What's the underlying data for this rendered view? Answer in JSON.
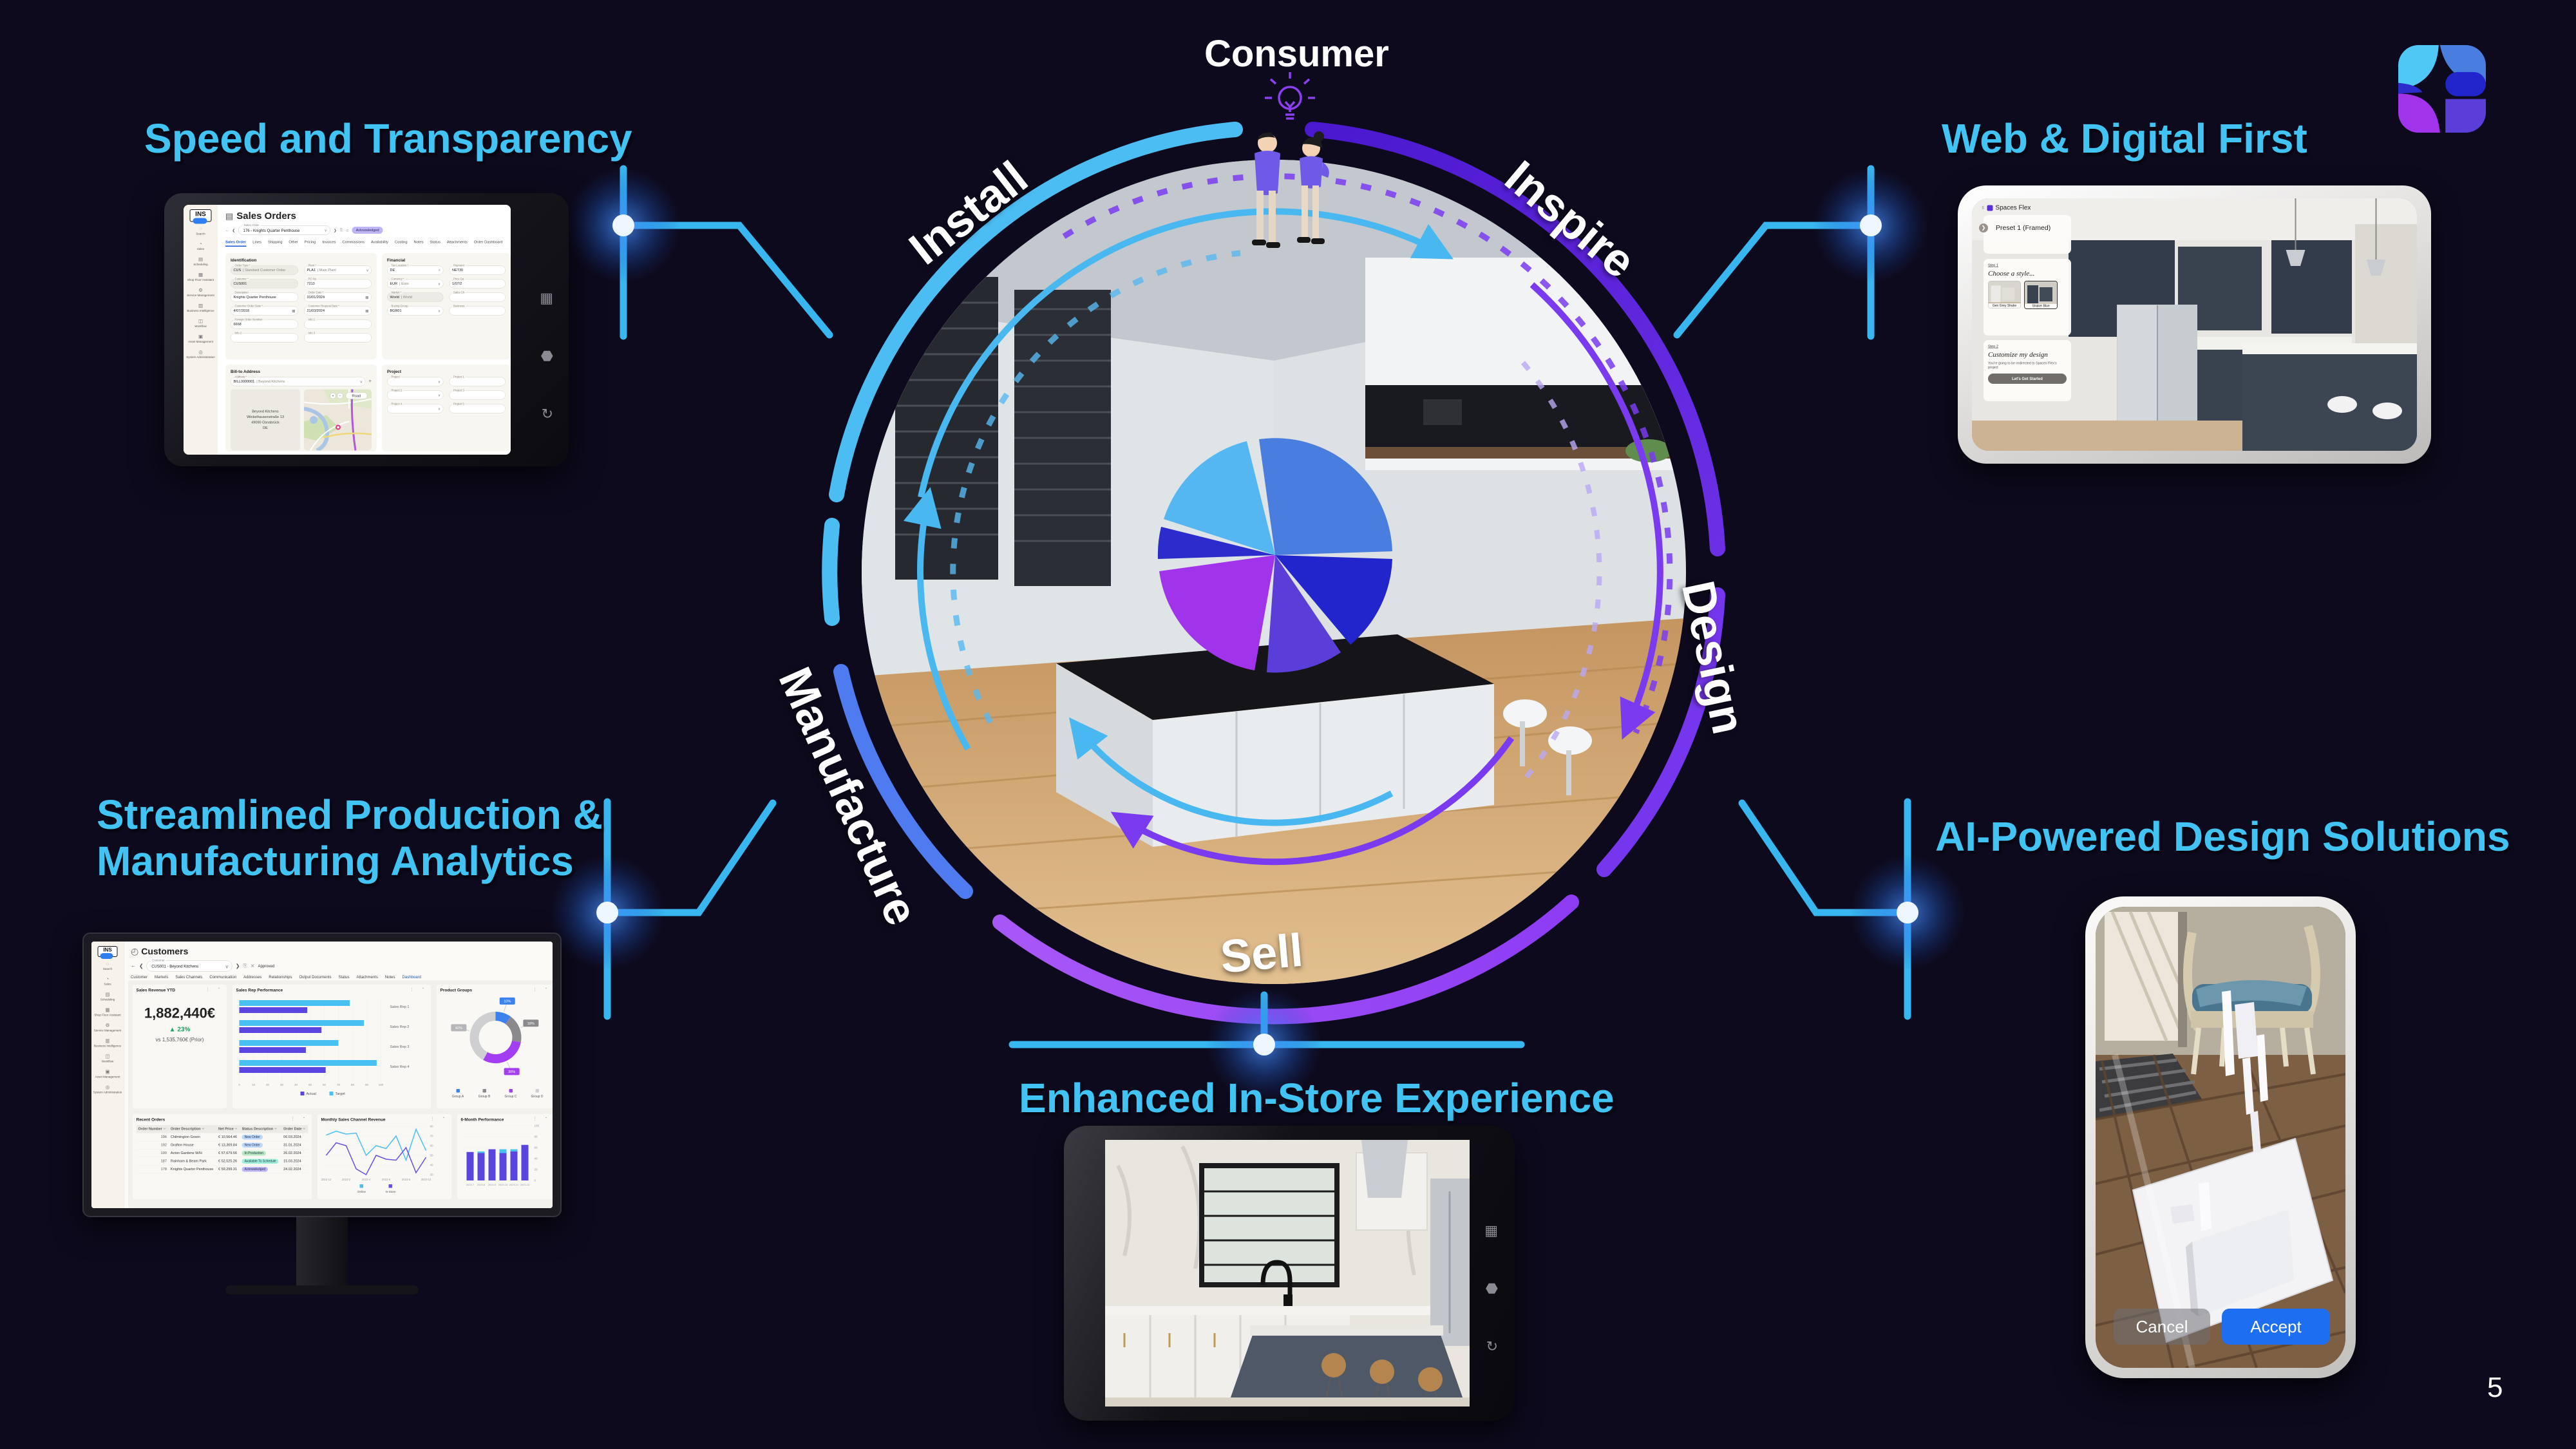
{
  "page": {
    "number": "5",
    "accent": "#41c3f3",
    "background": "#0d0a1d"
  },
  "titles": {
    "speed": "Speed and Transparency",
    "web": "Web & Digital First",
    "production_l1": "Streamlined Production &",
    "production_l2": "Manufacturing Analytics",
    "ai": "AI-Powered Design Solutions",
    "instore": "Enhanced In-Store Experience"
  },
  "cycle": {
    "consumer": "Consumer",
    "stages": {
      "install": "Install",
      "inspire": "Inspire",
      "design": "Design",
      "sell": "Sell",
      "manufacture": "Manufacture"
    },
    "ring_colors": {
      "cyan": "#4bbdf2",
      "purple_dark": "#5122d2",
      "purple": "#7636ee",
      "magenta": "#9d4cf5",
      "blue": "#4e7cf0"
    }
  },
  "erp": {
    "logo": "INS",
    "title": "Sales Orders",
    "selector_label": "Sales Order",
    "selector_value": "176 - Knights Quarter Penthouse",
    "status_badge": "Acknowledged",
    "tabs": [
      "Sales Order",
      "Lines",
      "Shipping",
      "Other",
      "Pricing",
      "Invoices",
      "Commissions",
      "Availability",
      "Costing",
      "Notes",
      "Status",
      "Attachments",
      "Order Dashboard"
    ],
    "sidebar": [
      "Search",
      "Sales",
      "Scheduling",
      "Shop Floor Assistant",
      "Service Management",
      "Business Intelligence",
      "Workflow",
      "Asset Management",
      "System Administration"
    ],
    "sections": {
      "identification": "Identification",
      "financial": "Financial",
      "billto": "Bill-to Address",
      "project": "Project"
    },
    "id_left": [
      {
        "l": "Order Type *",
        "v": "CUS",
        "s": "| Standard Customer Order",
        "grey": true
      },
      {
        "l": "Customer *",
        "v": "CUS001",
        "grey": true
      },
      {
        "l": "Description",
        "v": "Knights Quarter Penthouse"
      },
      {
        "l": "Customer Order Date *",
        "v": "4/07/2018",
        "icon": "date"
      },
      {
        "l": "Foreign Order Number",
        "v": "6668"
      },
      {
        "l": "Info 2",
        "v": ""
      }
    ],
    "id_right": [
      {
        "l": "Plant *",
        "v": "PLA1",
        "s": "| Main Plant",
        "icon": "select"
      },
      {
        "l": "PO No",
        "v": "7213"
      },
      {
        "l": "Order Date *",
        "v": "31/01/2024",
        "icon": "date"
      },
      {
        "l": "Customer Request Date *",
        "v": "21/03/2024",
        "icon": "date"
      },
      {
        "l": "Info 1",
        "v": ""
      },
      {
        "l": "Info 3",
        "v": ""
      }
    ],
    "fin_left": [
      {
        "l": "Tax Location *",
        "v": "DE",
        "icon": "search"
      },
      {
        "l": "Currency *",
        "v": "EUR",
        "s": "| Euro",
        "icon": "select"
      },
      {
        "l": "Market *",
        "v": "World",
        "s": "| World",
        "grey": true
      },
      {
        "l": "Buying Group",
        "v": "BGR01",
        "icon": "select"
      }
    ],
    "fin_right": [
      {
        "l": "Payment",
        "v": "NET30"
      },
      {
        "l": "Price Da",
        "v": "1/07/2"
      },
      {
        "l": "Sales Ch",
        "v": ""
      },
      {
        "l": "Business",
        "v": ""
      }
    ],
    "address_code": "BILL0000001",
    "address_name": "| Beyond Kitchens",
    "address_lines": [
      "Beyond Kitchens",
      "Winkelhausenstraße 13",
      "49090 Osnabrück",
      "DE"
    ],
    "map_button": "Road",
    "project_left": [
      "Project",
      "Project 2",
      "Project 4"
    ],
    "project_right": [
      "Project 1",
      "Project 3",
      "Project 5"
    ]
  },
  "spaces": {
    "app": "Spaces Flex",
    "preset": "Preset 1 (Framed)",
    "step1_label": "Step 1",
    "step1_title": "Choose a style...",
    "styles": [
      "Gen Grey Shake",
      "Shaker Blue"
    ],
    "step2_label": "Step 2",
    "step2_title": "Customize my design",
    "step2_note": "You're going to be redirected to Spaces Flex's project",
    "cta": "Let's Get Started"
  },
  "dash": {
    "title": "Customers",
    "selector": "CUS001 - Beyond Kitchens",
    "status": "Approved",
    "tabs": [
      "Customer",
      "Markets",
      "Sales Channels",
      "Communication",
      "Addresses",
      "Relationships",
      "Output Documents",
      "Status",
      "Attachments",
      "Notes",
      "Dashboard"
    ],
    "active_tab": 10,
    "sidebar": [
      "Search",
      "Sales",
      "Scheduling",
      "Shop Floor Assistant",
      "Service Management",
      "Business Intelligence",
      "Workflow",
      "Asset Management",
      "System Administration"
    ],
    "cards": {
      "revenue": "Sales Revenue YTD",
      "reps": "Sales Rep Performance",
      "groups": "Product Groups",
      "orders": "Recent Orders",
      "monthly": "Monthly Sales Channel Revenue",
      "sixmonth": "6-Month Performance"
    },
    "revenue": {
      "value": "1,882,440€",
      "delta": "▲ 23%",
      "prior": "vs 1,535,760€ (Prior)"
    },
    "orders_columns": [
      "Order Number",
      "Order Description",
      "Net Price",
      "Status Description",
      "Order Date"
    ],
    "orders_rows": [
      [
        "196",
        "Chilmington Green",
        "€ 10,564.46",
        "New Order",
        "06.03.2024"
      ],
      [
        "192",
        "Grafton House",
        "€ 13,369.84",
        "New Order",
        "31.01.2024"
      ],
      [
        "190",
        "Acton Gardens W/H",
        "€ 57,679.56",
        "In Production",
        "26.02.2024"
      ],
      [
        "187",
        "Rainham & Beam Park",
        "€ 52,525.26",
        "Available To Schedule",
        "15.03.2024"
      ],
      [
        "178",
        "Knights Quarter Penthouse",
        "€ 59,299.31",
        "Acknowledged",
        "24.02.2024"
      ]
    ],
    "status_colors": {
      "New Order": "#bcd7fb",
      "In Production": "#b9e7bf",
      "Available To Schedule": "#9ff0d9",
      "Acknowledged": "#beb5f7"
    }
  },
  "ar": {
    "cancel": "Cancel",
    "accept": "Accept"
  },
  "chart_data": [
    {
      "type": "bar",
      "orientation": "horizontal",
      "title": "Sales Rep Performance",
      "categories": [
        "Sales Rep 1",
        "Sales Rep 2",
        "Sales Rep 3",
        "Sales Rep 4"
      ],
      "series": [
        {
          "name": "Target",
          "color": "#49c0f2",
          "values": [
            78,
            88,
            70,
            97
          ]
        },
        {
          "name": "Actual",
          "color": "#5b45e0",
          "values": [
            48,
            58,
            47,
            61
          ]
        }
      ],
      "xlim": [
        0,
        100
      ],
      "xticks": [
        0,
        10,
        20,
        30,
        40,
        50,
        60,
        70,
        80,
        90,
        100
      ],
      "legend": [
        "Actual",
        "Target"
      ],
      "legend_colors": [
        "#5b45e0",
        "#49c0f2"
      ]
    },
    {
      "type": "pie",
      "title": "Product Groups",
      "labels": [
        "Group A",
        "Group B",
        "Group C",
        "Group D"
      ],
      "values": [
        10,
        18,
        30,
        42
      ],
      "colors": [
        "#3b82ef",
        "#8a8a8e",
        "#a43ef2",
        "#cfcfd2"
      ],
      "callouts": [
        "10%",
        "18%",
        "30%",
        "42%"
      ]
    },
    {
      "type": "line",
      "title": "Monthly Sales Channel Revenue",
      "x_labels": [
        "2022-12",
        "2023-2",
        "2023-4",
        "2023-6",
        "2023-8",
        "2023-10"
      ],
      "series": [
        {
          "name": "Online",
          "color": "#49c0f2",
          "values": [
            71,
            75,
            72,
            73,
            50,
            60,
            57,
            70,
            45,
            77,
            55
          ]
        },
        {
          "name": "In-Store",
          "color": "#6d4de2",
          "values": [
            50,
            63,
            60,
            36,
            30,
            50,
            46,
            45,
            58,
            32,
            48
          ]
        }
      ],
      "ylim": [
        30,
        80
      ],
      "yticks": [
        30,
        40,
        50,
        60,
        70,
        80
      ]
    },
    {
      "type": "bar",
      "stacked": true,
      "title": "6-Month Performance",
      "categories": [
        "2023-7",
        "2023-8",
        "2023-9",
        "2023-10",
        "2023-11",
        "2023-12"
      ],
      "series": [
        {
          "name": "In-Store",
          "color": "#5b45e0",
          "values": [
            52,
            50,
            57,
            50,
            53,
            65
          ]
        },
        {
          "name": "Online",
          "color": "#49c0f2",
          "values": [
            0,
            3,
            0,
            7,
            4,
            0
          ]
        }
      ],
      "ylim": [
        0,
        100
      ],
      "yticks": [
        0,
        20,
        40,
        60,
        80,
        100
      ]
    }
  ]
}
